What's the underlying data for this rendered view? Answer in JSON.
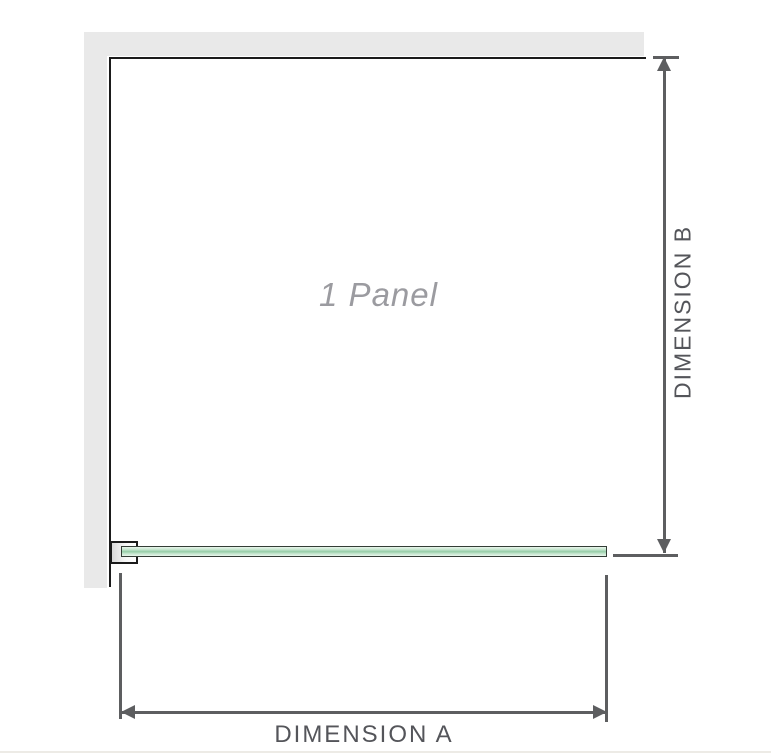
{
  "diagram": {
    "title": "1 Panel",
    "dimension_a": {
      "label": "DIMENSION A"
    },
    "dimension_b": {
      "label": "DIMENSION B"
    }
  },
  "colors": {
    "wall": "#e9e9e9",
    "outline": "#1b1b1b",
    "dimension": "#5d5e60",
    "label_text": "#54555a",
    "panel_text": "#9b9ba0",
    "glass_border": "#333d36",
    "glass_light": "#e9f5ec",
    "glass_mid": "#95cda8",
    "baseline_rule": "#edebe6"
  }
}
